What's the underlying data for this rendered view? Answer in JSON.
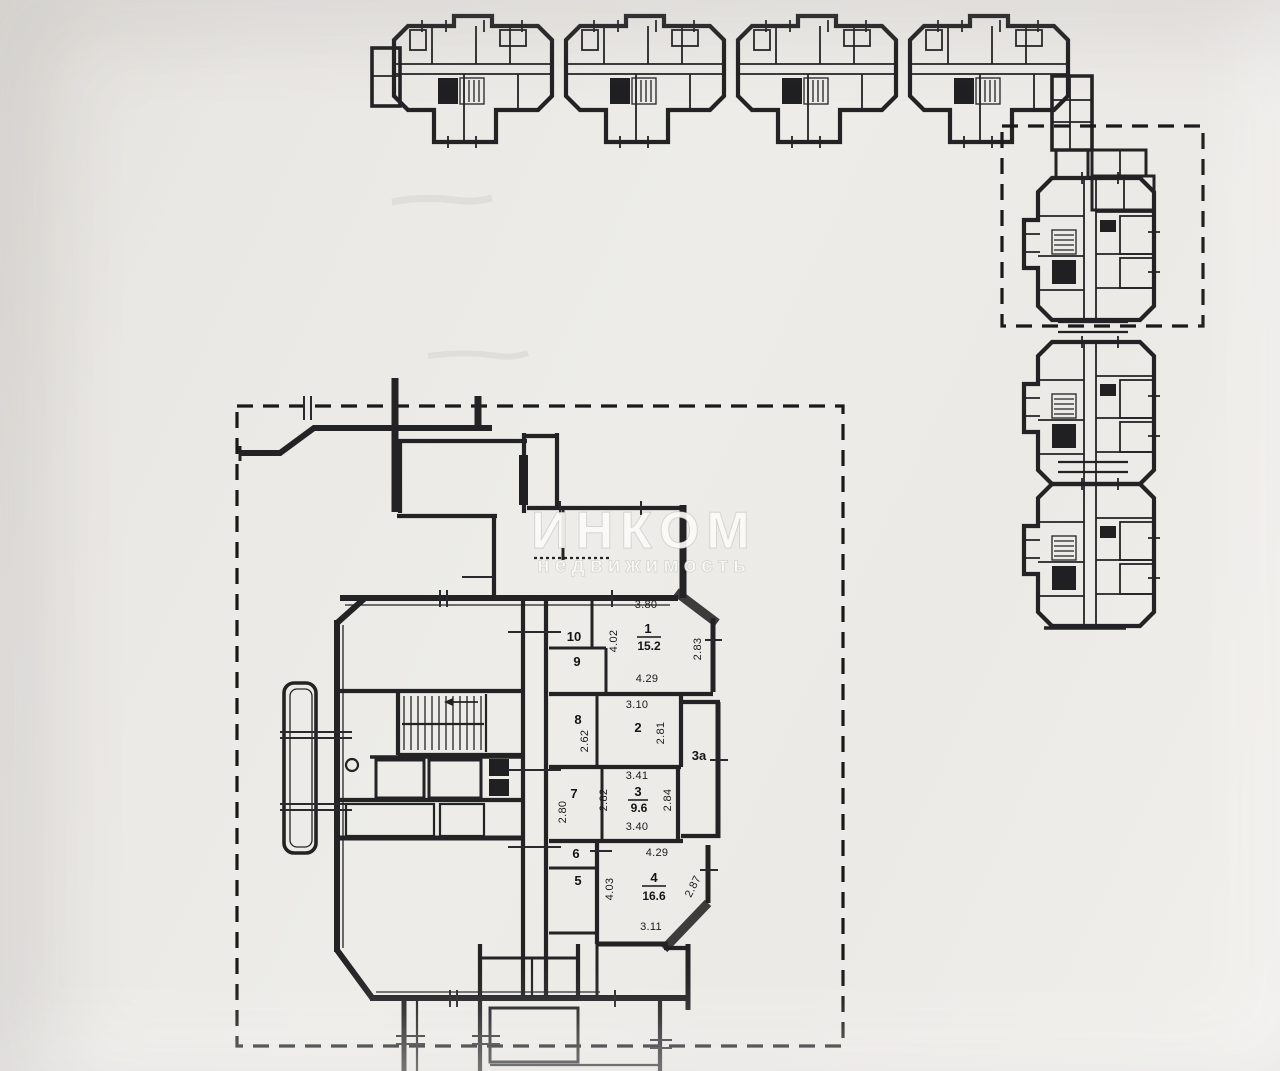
{
  "watermark": {
    "title": "ИНКОМ",
    "subtitle": "недвижимость"
  },
  "plan": {
    "rooms": {
      "r1": {
        "num": "1",
        "area": "15.2",
        "dim_top": "3.80",
        "dim_left": "4.02",
        "dim_right": "2.83",
        "dim_bottom": "4.29"
      },
      "r2": {
        "num": "2",
        "dim_top": "3.10",
        "dim_right": "2.81"
      },
      "r3": {
        "num": "3",
        "area": "9.6",
        "dim_top": "3.41",
        "dim_left": "2.82",
        "dim_right": "2.84",
        "dim_bottom": "3.40"
      },
      "r3a": {
        "num": "3а"
      },
      "r4": {
        "num": "4",
        "area": "16.6",
        "dim_top": "4.29",
        "dim_left": "4.03",
        "dim_right": "2.87",
        "dim_bottom": "3.11"
      },
      "r5": {
        "num": "5"
      },
      "r6": {
        "num": "6"
      },
      "r7": {
        "num": "7",
        "dim_left": "2.80"
      },
      "r8": {
        "num": "8",
        "dim_left": "2.62"
      },
      "r9": {
        "num": "9"
      },
      "r10": {
        "num": "10"
      }
    }
  },
  "colors": {
    "paper": "#eceae6",
    "ink": "#232326",
    "watermark": "#fbfaf7"
  }
}
